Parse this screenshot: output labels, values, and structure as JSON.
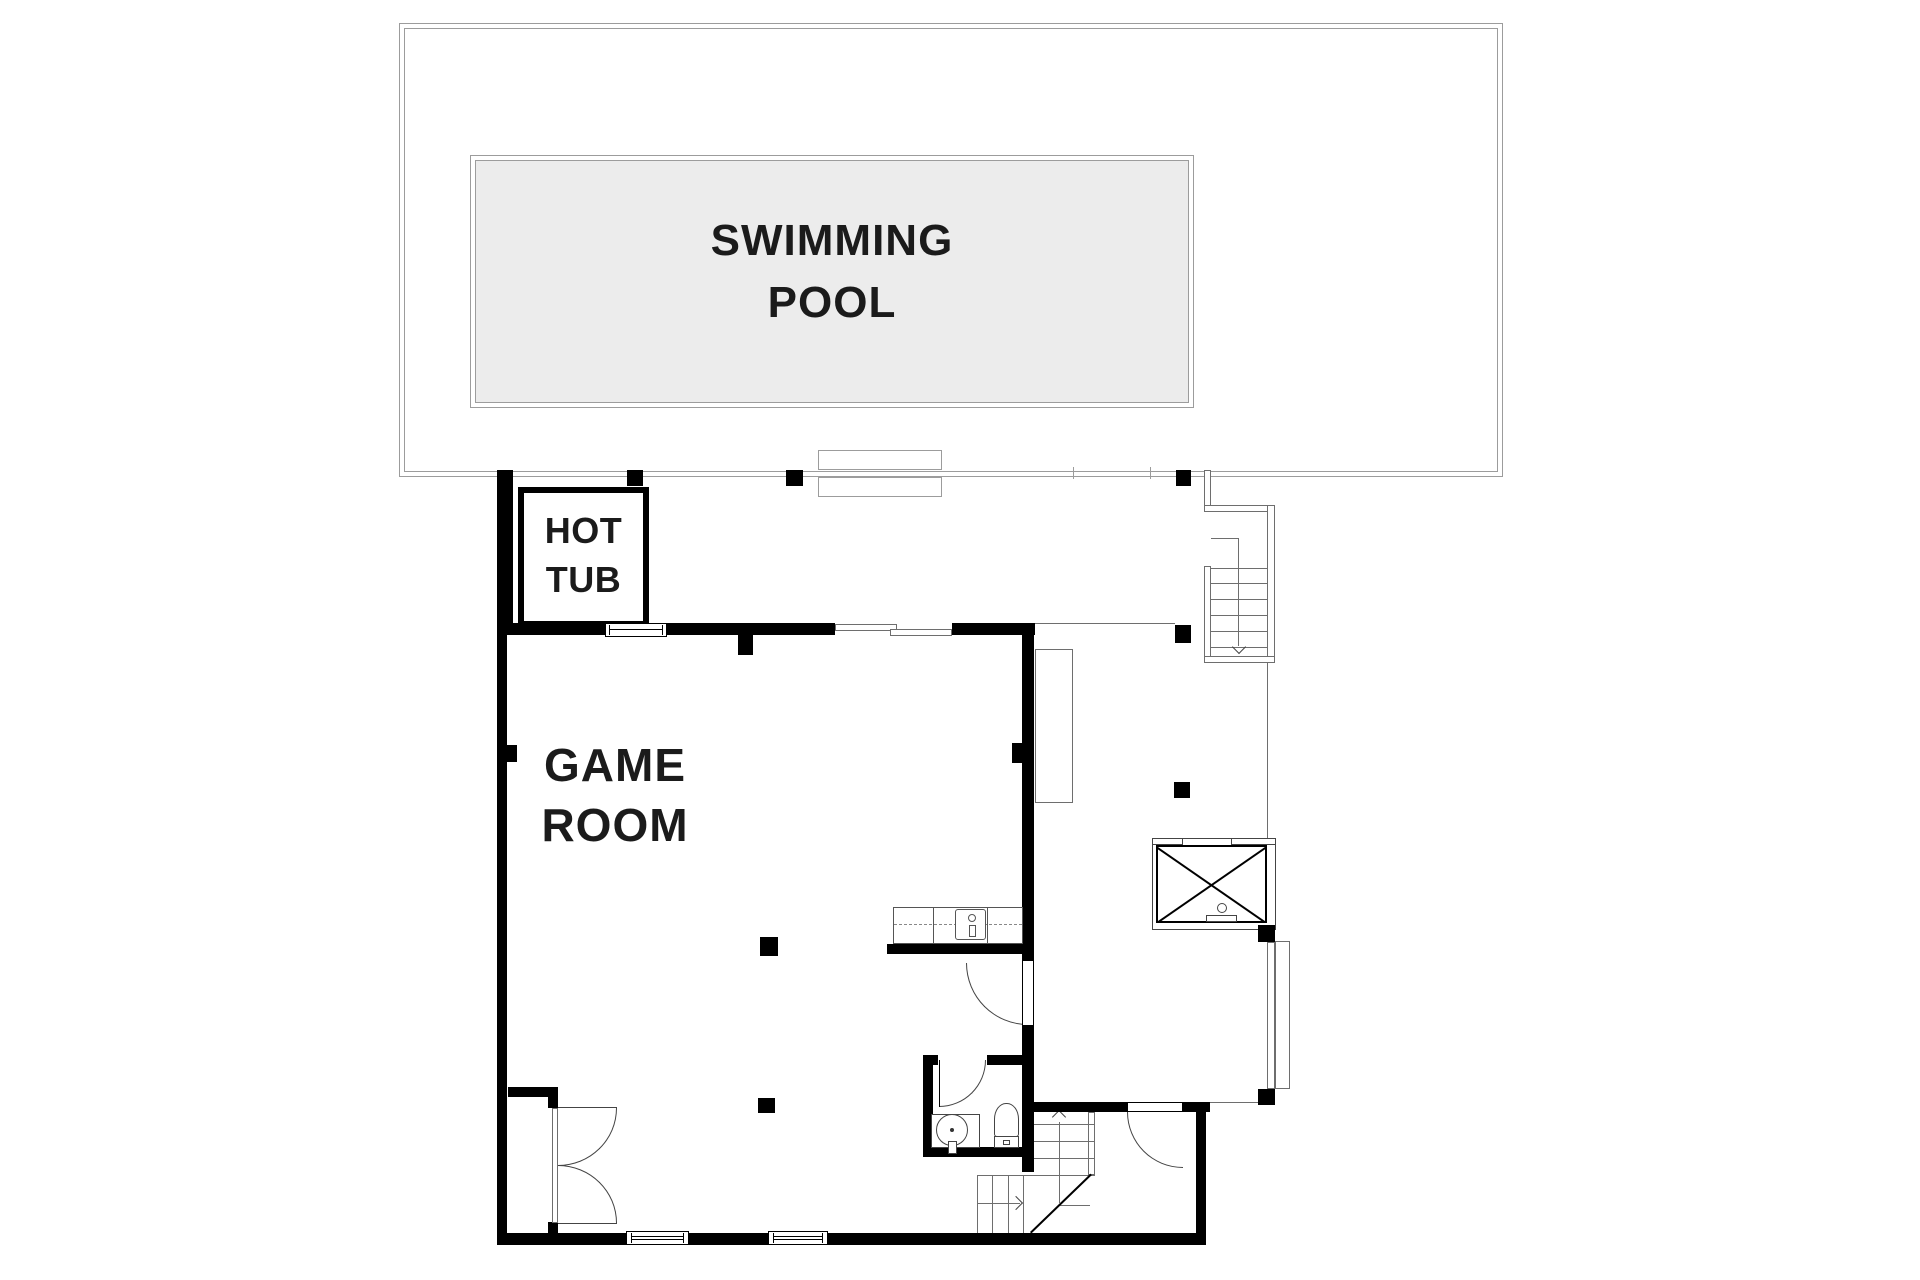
{
  "page": {
    "type": "architectural-floor-plan",
    "background": "#ffffff"
  },
  "labels": {
    "swimming_pool": "SWIMMING\nPOOL",
    "hot_tub": "HOT\nTUB",
    "game_room": "GAME\nROOM"
  },
  "colors": {
    "wall": "#000000",
    "thin_line": "#6e6e6e",
    "deck_line": "#9c9c9c",
    "pool_fill": "#ececec",
    "label_text": "#1b1b1b",
    "background": "#ffffff"
  },
  "features": {
    "labeled_rooms": [
      "swimming-pool",
      "hot-tub",
      "game-room"
    ],
    "unlabeled_spaces": [
      "pool-deck",
      "terrace-hallway",
      "bathroom",
      "closet",
      "entry-vestibule"
    ],
    "stairs": [
      {
        "name": "deck-stair",
        "direction_icon": "down-arrow"
      },
      {
        "name": "main-stair",
        "direction_icons": [
          "right-arrow",
          "up-arrow"
        ]
      }
    ],
    "doors": [
      "french-double-door",
      "game-room-side-door",
      "bathroom-door",
      "closet-door"
    ],
    "windows": [
      "top-wall-window",
      "top-wall-sliding-door",
      "bottom-window-1",
      "bottom-window-2",
      "right-sliding-door"
    ],
    "fixtures": [
      "pool-steps",
      "hot-tub",
      "bar-counter-with-sink",
      "washbasin",
      "toilet",
      "skylight-x-box",
      "shower-fixture",
      "columns"
    ]
  }
}
